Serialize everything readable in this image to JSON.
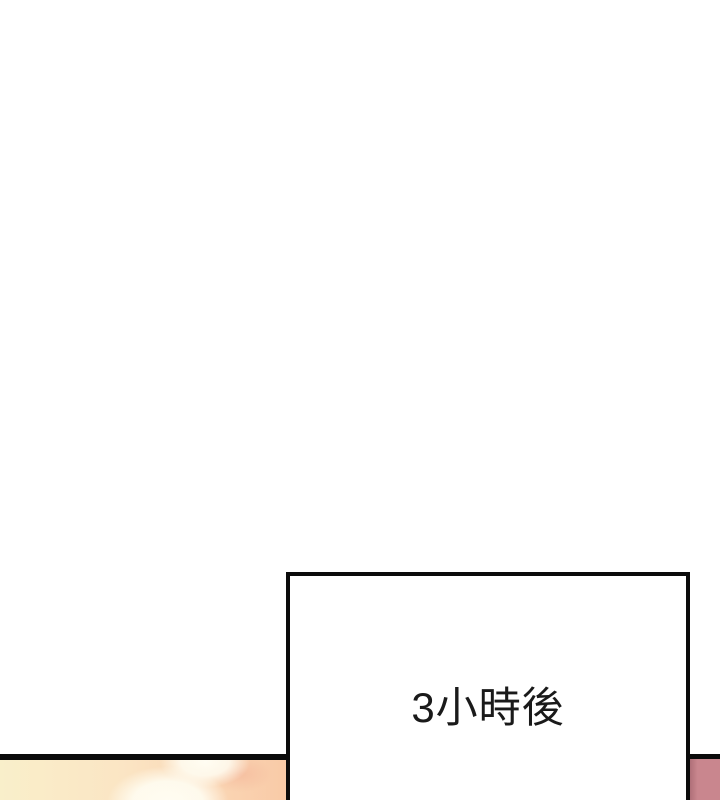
{
  "caption": {
    "text": "3小時後"
  },
  "colors": {
    "page-bg": "#ffffff",
    "line-color": "#0b0b0b",
    "text-color": "#1a1a1a",
    "art-left": "#f9efca",
    "art-mid": "#fbe5c4",
    "art-right": "#f9c9a6",
    "art-highlight": "#fffdf2",
    "rose-edge": "#a86a73",
    "rose-fill": "#c9868e"
  }
}
